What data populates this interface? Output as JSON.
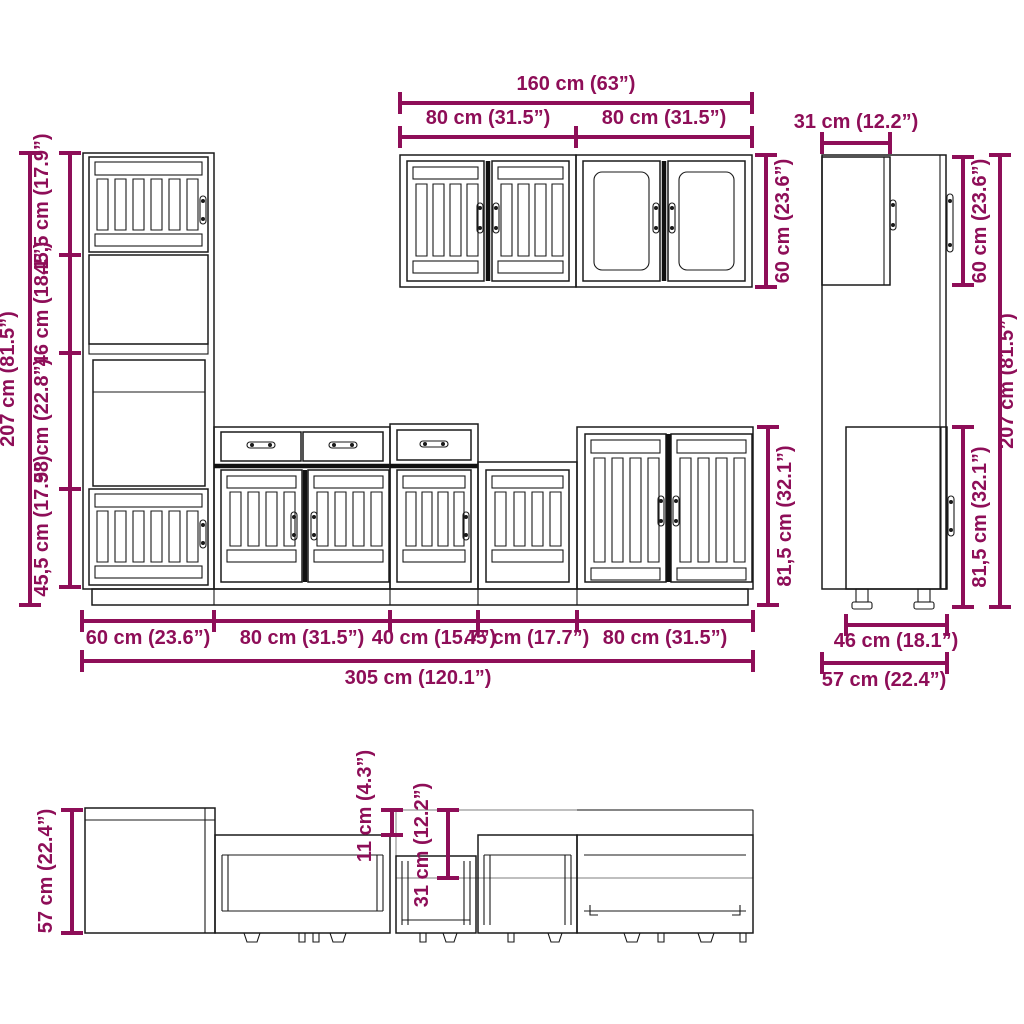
{
  "title": "Kitchen cabinet set dimension diagram",
  "colors": {
    "dimension_accent": "#8E0E58",
    "line_art": "#1a1a1a",
    "background": "#ffffff"
  },
  "front_view": {
    "tall_cabinet_total_height": "207 cm (81.5”)",
    "tall_sections": {
      "top_door": "45,5 cm (17.9”)",
      "open_shelf": "46 cm (18.1”)",
      "oven_space": "58 cm (22.8”)",
      "bottom_door": "45,5 cm (17.9”)"
    },
    "wall_cabinets": {
      "total_width": "160 cm (63”)",
      "left_width": "80 cm (31.5”)",
      "right_width": "80 cm (31.5”)",
      "height": "60 cm (23.6”)"
    },
    "base_cabinet_height": "81,5 cm (32.1”)",
    "unit_widths": {
      "tall": "60 cm (23.6”)",
      "base_80_left": "80 cm (31.5”)",
      "base_40": "40 cm (15.7”)",
      "base_45": "45 cm (17.7”)",
      "base_80_right": "80 cm (31.5”)"
    },
    "total_width": "305 cm (120.1”)"
  },
  "side_view": {
    "wall_cabinet_depth": "31 cm (12.2”)",
    "wall_cabinet_height": "60 cm (23.6”)",
    "total_height": "207 cm (81.5”)",
    "base_cabinet_height": "81,5 cm (32.1”)",
    "base_cabinet_depth": "46 cm (18.1”)",
    "total_depth": "57 cm (22.4”)"
  },
  "top_view": {
    "total_depth": "57 cm (22.4”)",
    "depth_offset": "11 cm (4.3”)",
    "wall_cabinet_depth": "31 cm (12.2”)"
  }
}
